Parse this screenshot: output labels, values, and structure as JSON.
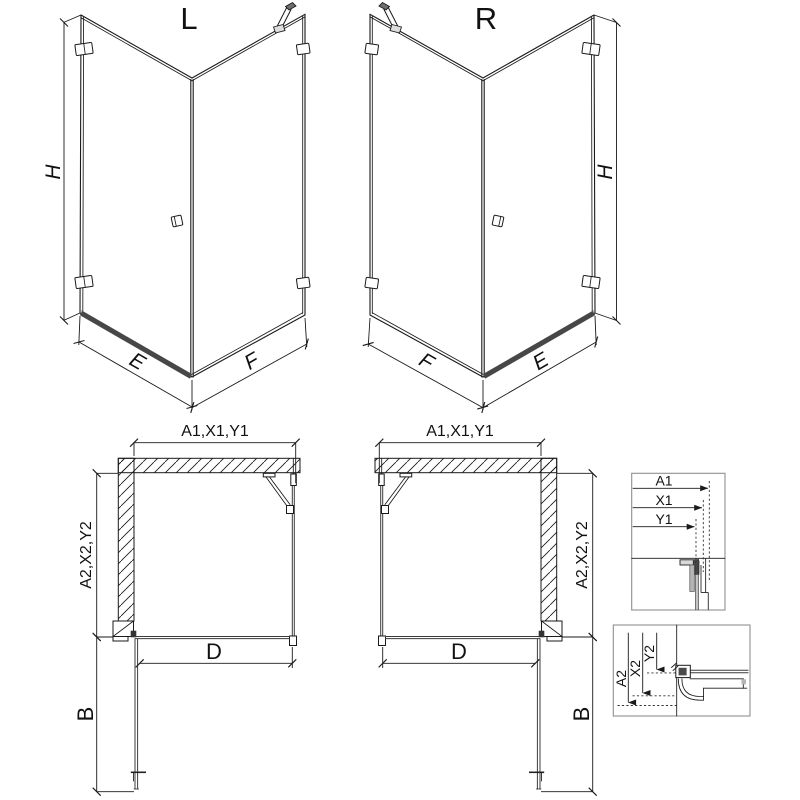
{
  "figures": {
    "iso_left": {
      "title": "L",
      "dim_height": "H",
      "dim_door_width": "E",
      "dim_fixed_width": "F"
    },
    "iso_right": {
      "title": "R",
      "dim_height": "H",
      "dim_door_width": "E",
      "dim_fixed_width": "F"
    },
    "plan_left": {
      "dim_top": "A1,X1,Y1",
      "dim_side": "A2,X2,Y2",
      "dim_door": "D",
      "dim_door_open": "B"
    },
    "plan_right": {
      "dim_top": "A1,X1,Y1",
      "dim_side": "A2,X2,Y2",
      "dim_door": "D",
      "dim_door_open": "B"
    },
    "detail_top": {
      "dim_1": "A1",
      "dim_2": "X1",
      "dim_3": "Y1"
    },
    "detail_bottom": {
      "dim_1": "A2",
      "dim_2": "X2",
      "dim_3": "Y2"
    }
  },
  "colors": {
    "line": "#1a1a1a",
    "glass_line": "#3c3c3c",
    "threshold": "#474747",
    "detail_frame": "#909090",
    "fill_dark": "#4a4a4a",
    "fill_gray": "#b5b5b5"
  }
}
